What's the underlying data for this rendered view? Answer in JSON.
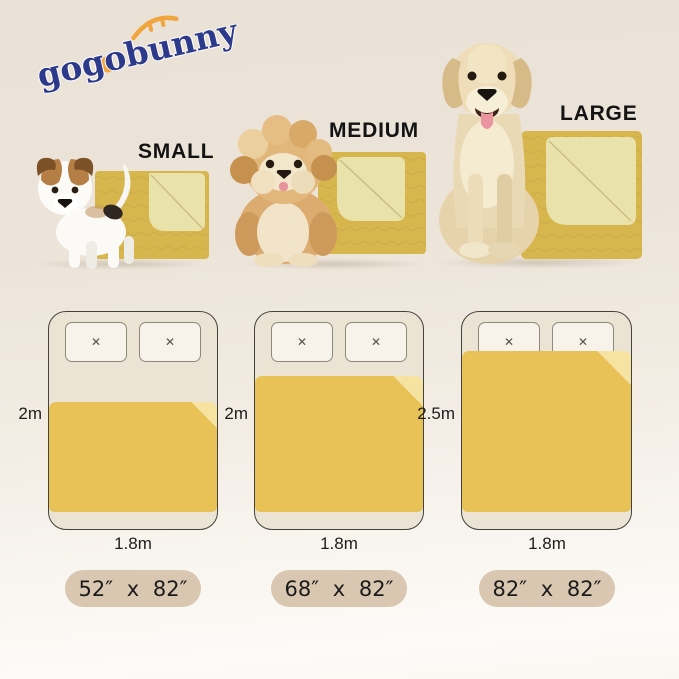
{
  "brand": {
    "logo_text": "gogobunny"
  },
  "products": [
    {
      "size_label": "SMALL",
      "pill_label": "52″ x 82″",
      "bed_length": "2m",
      "bed_width": "1.8m"
    },
    {
      "size_label": "MEDIUM",
      "pill_label": "68″ x 82″",
      "bed_length": "2m",
      "bed_width": "1.8m"
    },
    {
      "size_label": "LARGE",
      "pill_label": "82″ x 82″",
      "bed_length": "2.5m",
      "bed_width": "1.8m"
    }
  ],
  "icons": {
    "pillow_mark": "✕"
  },
  "colors": {
    "logo_navy": "#2d3a8c",
    "logo_orange": "#f0a53e",
    "blanket_yellow": "#e8c257",
    "blanket_fold": "#f6e3a2",
    "product_blanket": "#d7b64e",
    "product_blanket_fold": "#e9e2ab",
    "pill_bg": "#d9c7b1",
    "background_top": "#ece3d8",
    "background_bottom": "#fdfbf8"
  }
}
